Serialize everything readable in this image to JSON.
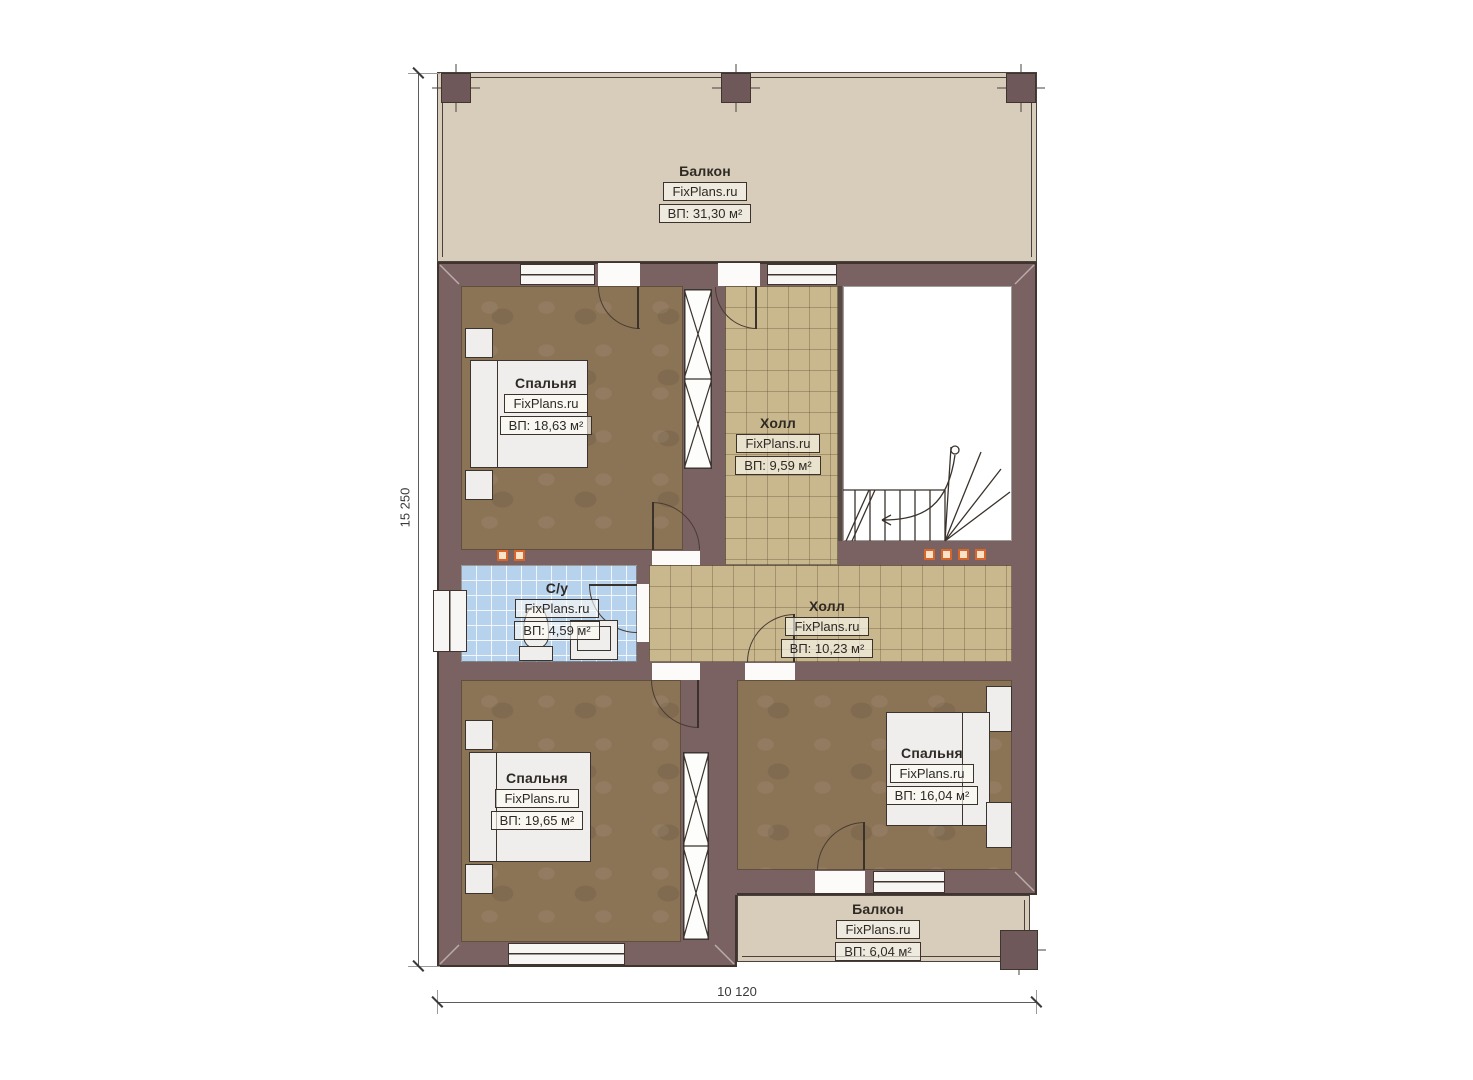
{
  "plan": {
    "type": "floor-plan",
    "floor_outer_dimensions": {
      "height_label": "15 250",
      "width_label": "10 120"
    },
    "watermark": "FixPlans.ru"
  },
  "rooms": [
    {
      "id": "balcony-top",
      "name": "Балкон",
      "watermark": "FixPlans.ru",
      "area": "ВП: 31,30 м²"
    },
    {
      "id": "bedroom-top-left",
      "name": "Спальня",
      "watermark": "FixPlans.ru",
      "area": "ВП: 18,63 м²"
    },
    {
      "id": "hall-upper",
      "name": "Холл",
      "watermark": "FixPlans.ru",
      "area": "ВП: 9,59 м²"
    },
    {
      "id": "bathroom",
      "name": "С/у",
      "watermark": "FixPlans.ru",
      "area": "ВП: 4,59 м²"
    },
    {
      "id": "hall-lower",
      "name": "Холл",
      "watermark": "FixPlans.ru",
      "area": "ВП: 10,23 м²"
    },
    {
      "id": "bedroom-bottom-left",
      "name": "Спальня",
      "watermark": "FixPlans.ru",
      "area": "ВП: 19,65 м²"
    },
    {
      "id": "bedroom-right",
      "name": "Спальня",
      "watermark": "FixPlans.ru",
      "area": "ВП: 16,04 м²"
    },
    {
      "id": "balcony-bottom",
      "name": "Балкон",
      "watermark": "FixPlans.ru",
      "area": "ВП: 6,04 м²"
    }
  ],
  "dims": {
    "height_label": "15 250",
    "width_label": "10 120"
  },
  "colors": {
    "wall": "#7a6263",
    "bedroom_floor": "#8b7356",
    "hall_tile": "#c9b78d",
    "bathroom_tile": "#b7d2ec",
    "balcony_floor": "#d8cdbb",
    "marker_orange": "#d8662b"
  }
}
